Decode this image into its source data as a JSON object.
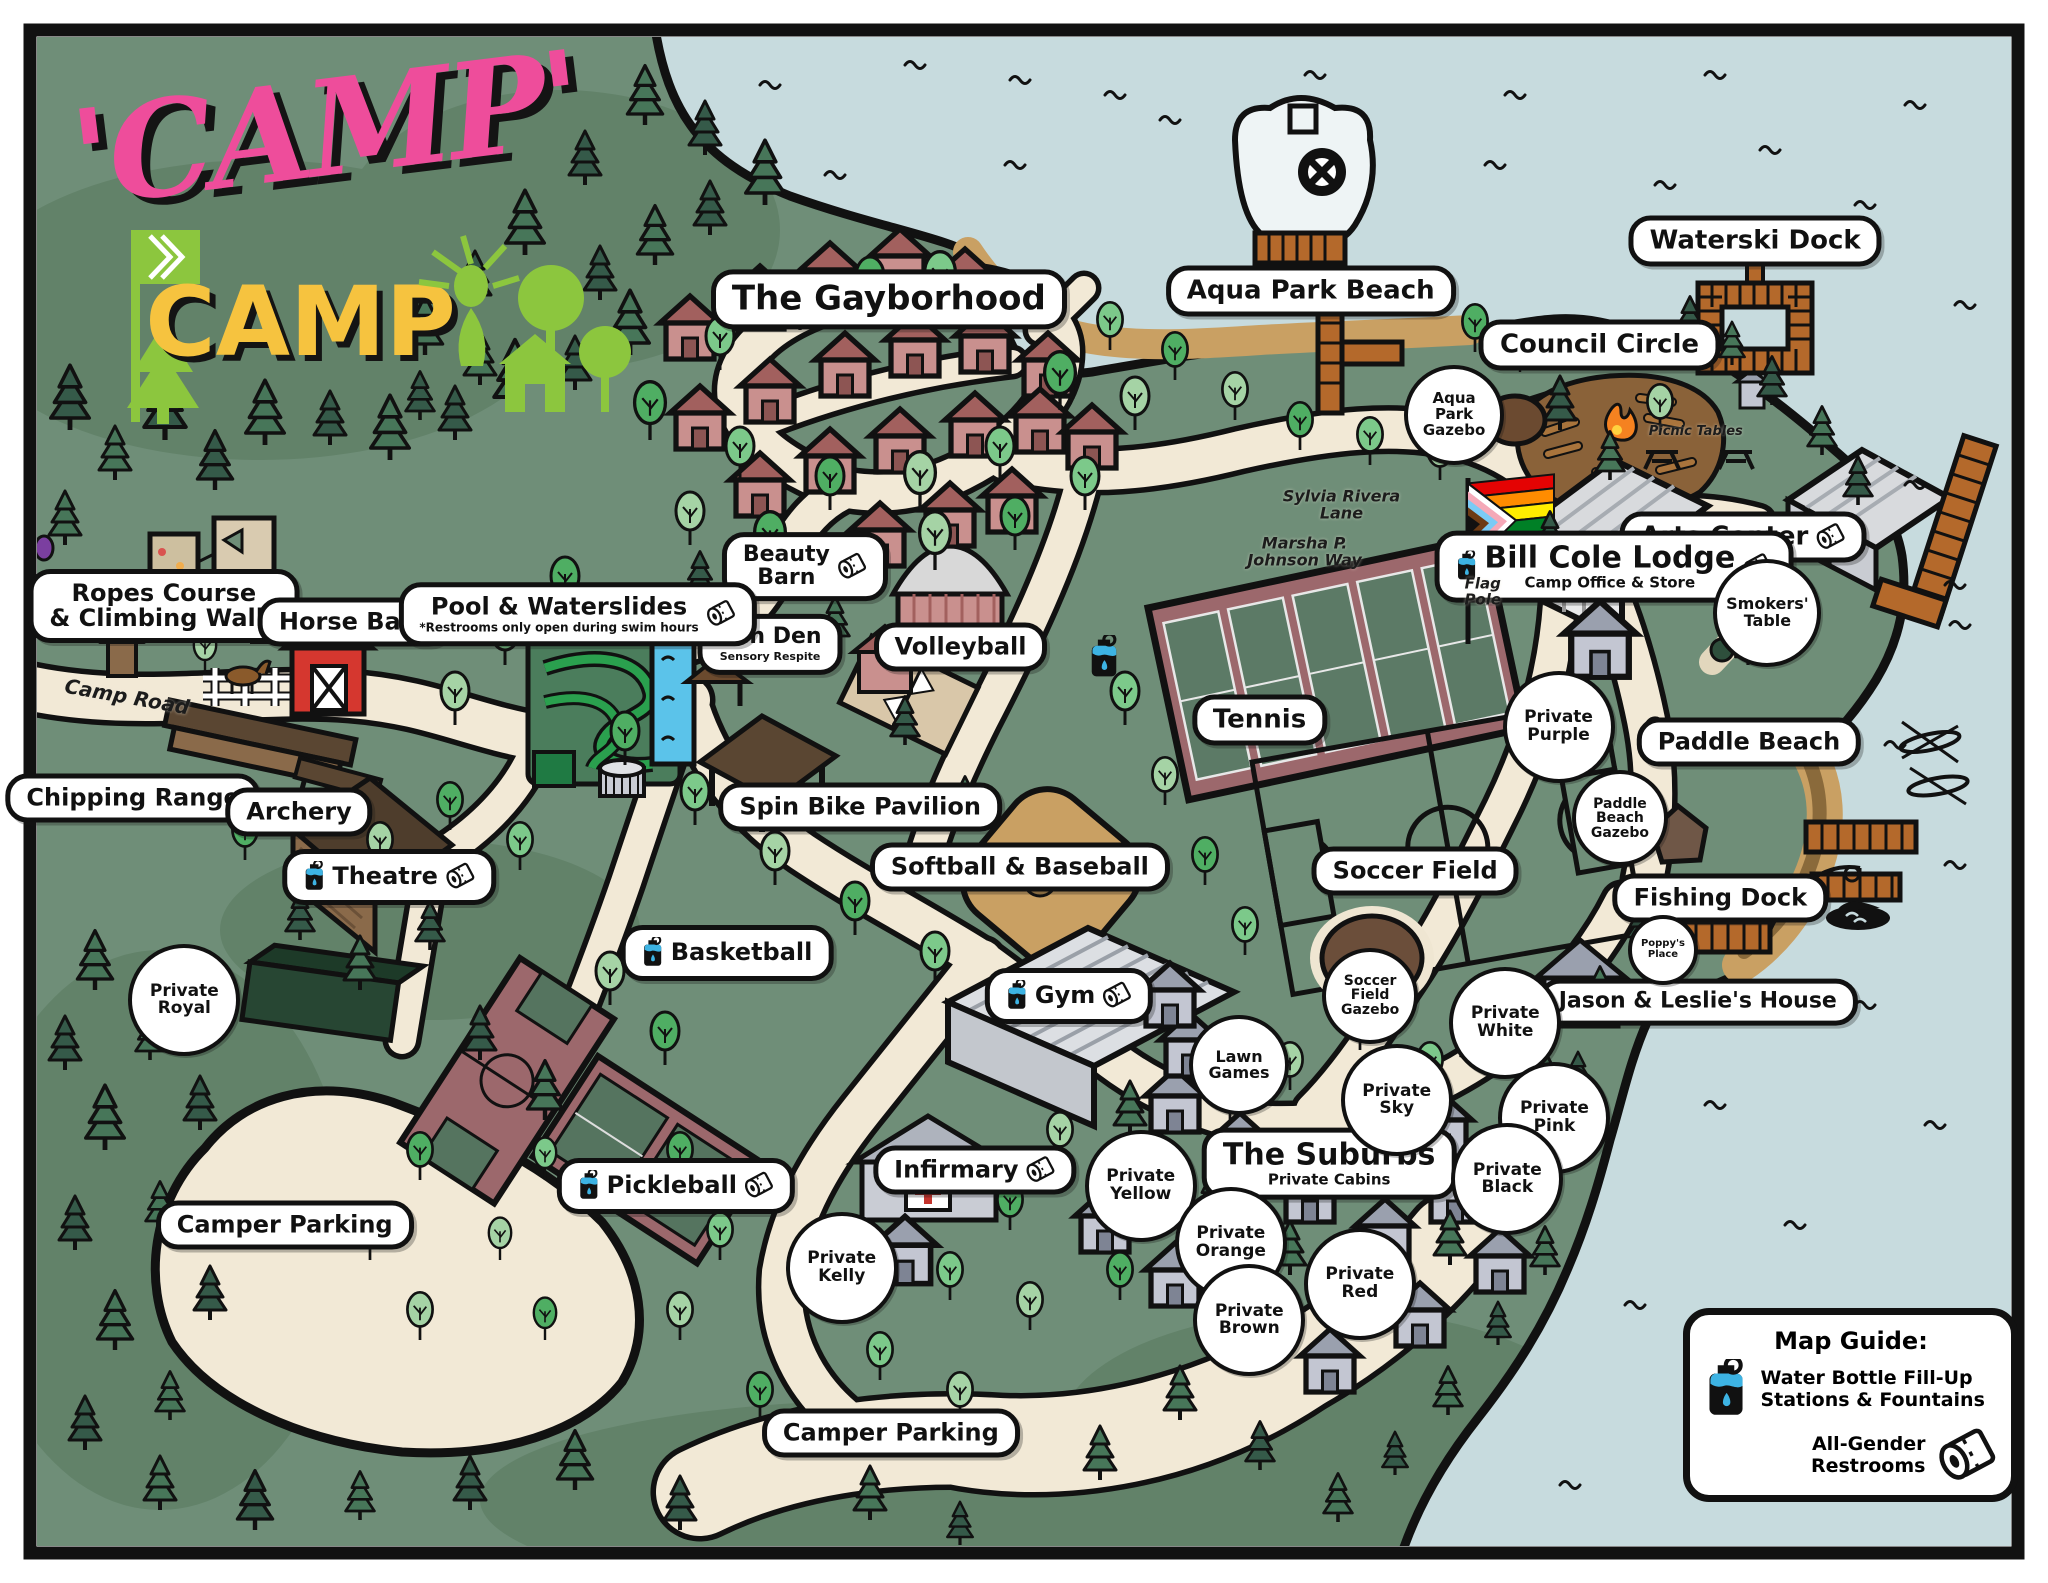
{
  "logo": {
    "word1": "'CAMP'",
    "word2": "CAMP"
  },
  "palette": {
    "land": "#6f8e78",
    "water": "#c7dbde",
    "trail": "#f2e9d6",
    "sand": "#c9a063",
    "dock": "#b4692b",
    "court_maroon": "#9c686c",
    "court_green": "#55745f",
    "cabin_pink": "#c9908e",
    "cabin_gray": "#c3c6d2",
    "barn_red": "#d5372f",
    "logo_pink": "#ee4d9b",
    "logo_yellow": "#f6c33f",
    "logo_green": "#8cc63e",
    "bottle_blue": "#3db3e3"
  },
  "map_labels": [
    {
      "id": "the-gayborhood",
      "type": "pill",
      "text": "The Gayborhood",
      "x": 43.4,
      "y": 18.9,
      "fs": 34
    },
    {
      "id": "aqua-park-beach",
      "type": "pill",
      "text": "Aqua Park Beach",
      "x": 64.0,
      "y": 18.4,
      "fs": 26
    },
    {
      "id": "waterski-dock",
      "type": "pill",
      "text": "Waterski Dock",
      "x": 85.7,
      "y": 15.2,
      "fs": 26
    },
    {
      "id": "council-circle",
      "type": "pill",
      "text": "Council Circle",
      "x": 78.1,
      "y": 21.8,
      "fs": 26
    },
    {
      "id": "arts-center",
      "type": "pill",
      "text": "Arts Center",
      "x": 85.1,
      "y": 33.9,
      "fs": 26,
      "icons": [
        "tp-after"
      ]
    },
    {
      "id": "bill-cole-lodge",
      "type": "pill",
      "text": "Bill Cole Lodge",
      "sub": "Camp Office & Store",
      "x": 78.8,
      "y": 35.8,
      "fs": 30,
      "icons": [
        "water-before",
        "tp-after"
      ]
    },
    {
      "id": "beauty-barn",
      "type": "pill",
      "text": "Beauty\nBarn",
      "x": 39.3,
      "y": 35.8,
      "fs": 22,
      "icons": [
        "tp-after"
      ]
    },
    {
      "id": "zen-den",
      "type": "pill",
      "text": "Zen Den",
      "sub": "Sensory Respite",
      "x": 37.6,
      "y": 40.7,
      "fs": 22
    },
    {
      "id": "volleyball",
      "type": "pill",
      "text": "Volleyball",
      "x": 46.9,
      "y": 40.9,
      "fs": 24
    },
    {
      "id": "tennis",
      "type": "pill",
      "text": "Tennis",
      "x": 61.5,
      "y": 45.5,
      "fs": 26
    },
    {
      "id": "ropes-course",
      "type": "pill",
      "text": "Ropes Course\n& Climbing Walls",
      "x": 8.0,
      "y": 38.3,
      "fs": 24
    },
    {
      "id": "horse-barn",
      "type": "pill",
      "text": "Horse Barn",
      "x": 17.3,
      "y": 39.3,
      "fs": 24
    },
    {
      "id": "pool-waterslides",
      "type": "pill",
      "text": "Pool & Waterslides",
      "sub": "*Restrooms only open during swim hours",
      "x": 28.2,
      "y": 38.8,
      "fs": 24,
      "icons": [
        "tp-after"
      ]
    },
    {
      "id": "chipping-range",
      "type": "pill",
      "text": "Chipping Range",
      "x": 6.5,
      "y": 50.4,
      "fs": 24
    },
    {
      "id": "archery",
      "type": "pill",
      "text": "Archery",
      "x": 14.6,
      "y": 51.3,
      "fs": 24
    },
    {
      "id": "theatre",
      "type": "pill",
      "text": "Theatre",
      "x": 19.0,
      "y": 55.4,
      "fs": 24,
      "icons": [
        "water-before",
        "tp-after"
      ]
    },
    {
      "id": "spin-bike-pavilion",
      "type": "pill",
      "text": "Spin Bike Pavilion",
      "x": 42.0,
      "y": 51.0,
      "fs": 24
    },
    {
      "id": "softball-baseball",
      "type": "pill",
      "text": "Softball & Baseball",
      "x": 49.8,
      "y": 54.8,
      "fs": 24
    },
    {
      "id": "soccer-field",
      "type": "pill",
      "text": "Soccer Field",
      "x": 69.1,
      "y": 55.0,
      "fs": 24
    },
    {
      "id": "paddle-beach",
      "type": "pill",
      "text": "Paddle Beach",
      "x": 85.4,
      "y": 46.9,
      "fs": 24
    },
    {
      "id": "fishing-dock",
      "type": "pill",
      "text": "Fishing Dock",
      "x": 84.0,
      "y": 56.7,
      "fs": 24
    },
    {
      "id": "jason-leslies-house",
      "type": "pill",
      "text": "Jason & Leslie's House",
      "x": 82.9,
      "y": 63.3,
      "fs": 22
    },
    {
      "id": "basketball",
      "type": "pill",
      "text": "Basketball",
      "x": 35.5,
      "y": 60.2,
      "fs": 24,
      "icons": [
        "water-before"
      ]
    },
    {
      "id": "gym",
      "type": "pill",
      "text": "Gym",
      "x": 52.2,
      "y": 62.9,
      "fs": 24,
      "icons": [
        "water-before",
        "tp-after"
      ]
    },
    {
      "id": "pickleball",
      "type": "pill",
      "text": "Pickleball",
      "x": 33.0,
      "y": 74.9,
      "fs": 24,
      "icons": [
        "water-before",
        "tp-after"
      ]
    },
    {
      "id": "infirmary",
      "type": "pill",
      "text": "Infirmary",
      "x": 47.6,
      "y": 73.9,
      "fs": 24,
      "icons": [
        "tp-after"
      ]
    },
    {
      "id": "the-suburbs",
      "type": "pill",
      "text": "The Suburbs",
      "sub": "Private Cabins",
      "x": 64.9,
      "y": 73.5,
      "fs": 30
    },
    {
      "id": "camper-parking-west",
      "type": "pill",
      "text": "Camper Parking",
      "x": 13.9,
      "y": 77.4,
      "fs": 24
    },
    {
      "id": "camper-parking-south",
      "type": "pill",
      "text": "Camper Parking",
      "x": 43.5,
      "y": 90.5,
      "fs": 24
    },
    {
      "id": "aqua-park-gazebo",
      "type": "circle",
      "text": "Aqua\nPark\nGazebo",
      "x": 71.0,
      "y": 26.2,
      "fs": 15,
      "d": 92
    },
    {
      "id": "smokers-table",
      "type": "circle",
      "text": "Smokers'\nTable",
      "x": 86.3,
      "y": 38.7,
      "fs": 16,
      "d": 100
    },
    {
      "id": "private-purple",
      "type": "circle",
      "text": "Private\nPurple",
      "x": 76.1,
      "y": 45.9
    },
    {
      "id": "paddle-beach-gazebo",
      "type": "circle",
      "text": "Paddle\nBeach\nGazebo",
      "x": 79.1,
      "y": 51.7,
      "fs": 14,
      "d": 88
    },
    {
      "id": "soccer-field-gazebo",
      "type": "circle",
      "text": "Soccer\nField\nGazebo",
      "x": 66.9,
      "y": 62.9,
      "fs": 14,
      "d": 88
    },
    {
      "id": "private-white",
      "type": "circle",
      "text": "Private\nWhite",
      "x": 73.5,
      "y": 64.6
    },
    {
      "id": "private-sky",
      "type": "circle",
      "text": "Private\nSky",
      "x": 68.2,
      "y": 69.5
    },
    {
      "id": "private-pink",
      "type": "circle",
      "text": "Private\nPink",
      "x": 75.9,
      "y": 70.6
    },
    {
      "id": "private-black",
      "type": "circle",
      "text": "Private\nBlack",
      "x": 73.6,
      "y": 74.5
    },
    {
      "id": "private-yellow",
      "type": "circle",
      "text": "Private\nYellow",
      "x": 55.7,
      "y": 74.9
    },
    {
      "id": "private-orange",
      "type": "circle",
      "text": "Private\nOrange",
      "x": 60.1,
      "y": 78.5
    },
    {
      "id": "private-brown",
      "type": "circle",
      "text": "Private\nBrown",
      "x": 61.0,
      "y": 83.4
    },
    {
      "id": "private-red",
      "type": "circle",
      "text": "Private\nRed",
      "x": 66.4,
      "y": 81.1
    },
    {
      "id": "private-royal",
      "type": "circle",
      "text": "Private\nRoyal",
      "x": 9.0,
      "y": 63.2
    },
    {
      "id": "private-kelly",
      "type": "circle",
      "text": "Private\nKelly",
      "x": 41.1,
      "y": 80.1
    },
    {
      "id": "lawn-games",
      "type": "circle",
      "text": "Lawn\nGames",
      "x": 60.5,
      "y": 67.3,
      "fs": 16,
      "d": 92
    },
    {
      "id": "poppys-place",
      "type": "circle",
      "text": "Poppy's\nPlace",
      "x": 81.2,
      "y": 60.0,
      "fs": 10,
      "d": 62
    },
    {
      "id": "camp-road",
      "type": "plain",
      "text": "Camp Road",
      "x": 6.2,
      "y": 44.0,
      "rot": 10,
      "fs": 20
    },
    {
      "id": "sylvia-rivera-lane",
      "type": "plain",
      "text": "Sylvia Rivera\nLane",
      "x": 65.5,
      "y": 31.9,
      "fs": 16
    },
    {
      "id": "marsha-p-johnson-way",
      "type": "plain",
      "text": "Marsha P.\nJohnson Way",
      "x": 63.7,
      "y": 34.9,
      "fs": 16
    },
    {
      "id": "flag-pole",
      "type": "plain",
      "text": "Flag\nPole",
      "x": 72.4,
      "y": 37.4,
      "fs": 15
    },
    {
      "id": "picnic-tables",
      "type": "plain",
      "text": "Picnic Tables",
      "x": 82.8,
      "y": 27.3,
      "fs": 13
    },
    {
      "id": "fill-station-court-junction",
      "type": "icon-water",
      "text": "",
      "x": 53.9,
      "y": 41.5
    }
  ],
  "legend": {
    "title": "Map Guide:",
    "items": [
      {
        "icon": "water-bottle-icon",
        "label": "Water Bottle Fill-Up Stations & Fountains"
      },
      {
        "icon": "toilet-paper-icon",
        "label": "All-Gender Restrooms"
      }
    ]
  }
}
